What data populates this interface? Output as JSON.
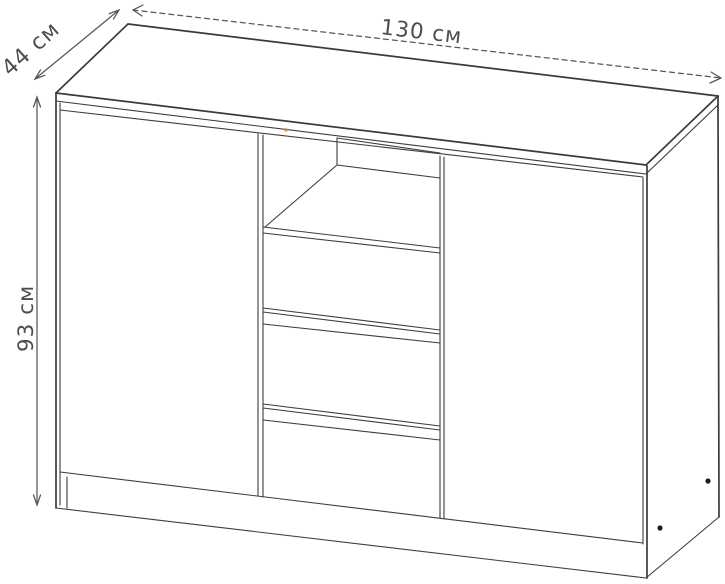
{
  "diagram": {
    "kind": "furniture-dimension-drawing",
    "object": "sideboard with two doors, open shelf niche and three central drawers",
    "dimensions": {
      "width": {
        "label": "130 см",
        "value": 130,
        "unit": "см"
      },
      "depth": {
        "label": "44 см",
        "value": 44,
        "unit": "см"
      },
      "height": {
        "label": "93 см",
        "value": 93,
        "unit": "см"
      }
    },
    "colors": {
      "background": "#ffffff",
      "line": "#3d3d3d",
      "dimension_line": "#575757",
      "label_text": "#4e4e4e",
      "screw_dot": "#1c1c1c",
      "artifact_speck": "#c4874a"
    }
  }
}
